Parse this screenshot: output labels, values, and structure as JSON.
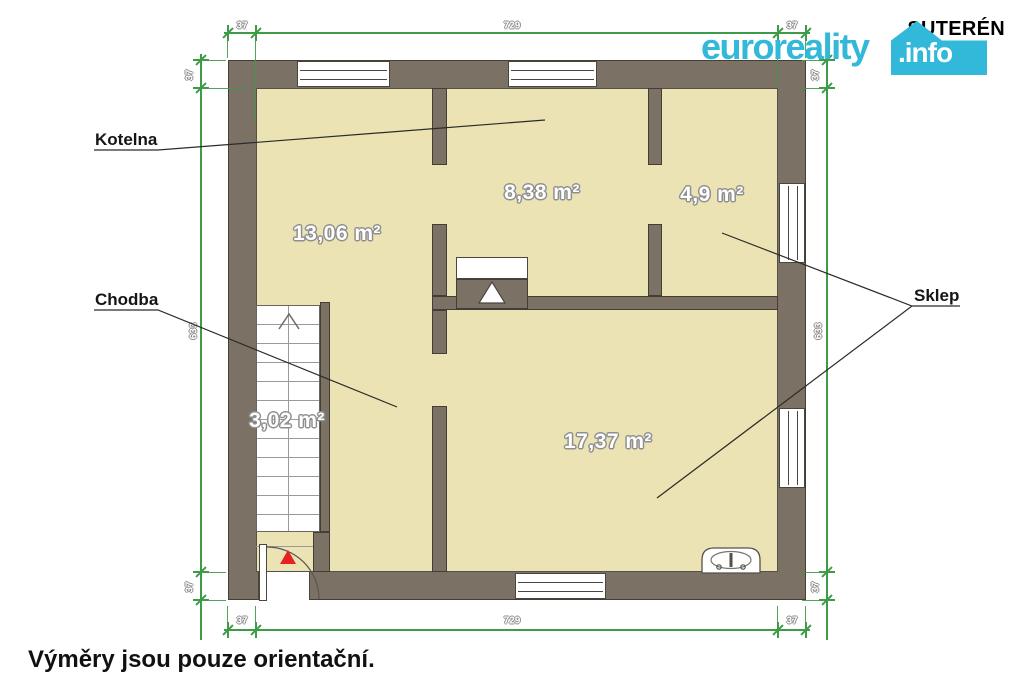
{
  "title": "SUTERÉN",
  "logo": {
    "brand": "euroreality",
    "tld": ".info"
  },
  "rooms": {
    "kotelna_label": "Kotelna",
    "chodba_label": "Chodba",
    "sklep_label": "Sklep",
    "areas": {
      "top_left": "13,06 m²",
      "top_middle": "8,38 m²",
      "top_right": "4,9 m²",
      "stairs": "3,02 m²",
      "bottom_right": "17,37 m²"
    }
  },
  "dimensions": {
    "top": [
      "37",
      "729",
      "37"
    ],
    "bottom": [
      "37",
      "729",
      "37"
    ],
    "left": [
      "37",
      "633",
      "37"
    ],
    "right": [
      "37",
      "633",
      "37"
    ]
  },
  "footer": {
    "disclaimer": "Výměry jsou pouze orientační."
  },
  "colors": {
    "wall": "#7b7265",
    "floor": "#ebe3b3",
    "dimension_green": "#3e9b47",
    "brand_cyan": "#32b8d8",
    "entrance_red": "#e62121"
  }
}
